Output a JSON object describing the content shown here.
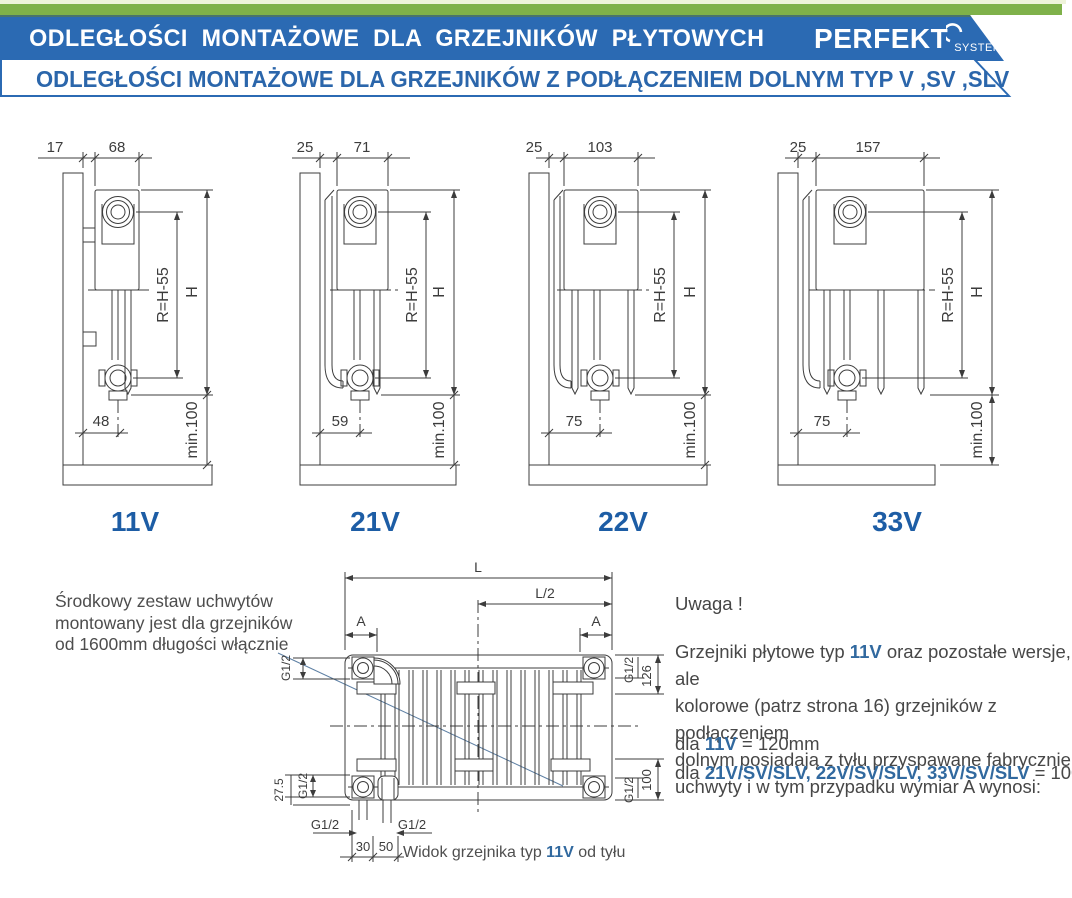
{
  "header": {
    "title": "ODLEGŁOŚCI MONTAŻOWE DLA GRZEJNIKÓW PŁYTOWYCH",
    "brand": "PERFEKT",
    "brand_sub": "SYSTEM",
    "subtitle": "ODLEGŁOŚCI MONTAŻOWE DLA GRZEJNIKÓW Z PODŁĄCZENIEM DOLNYM TYP V ,SV ,SLV",
    "colors": {
      "banner_blue": "#2b6ab3",
      "green": "#7fb14a",
      "accent_blue": "#31699f"
    }
  },
  "diagrams": [
    {
      "type_label": "11V",
      "dim_wall_gap": "17",
      "dim_depth": "68",
      "dim_bottom": "48",
      "dim_height": "H",
      "dim_r": "R=H-55",
      "dim_min": "min.100"
    },
    {
      "type_label": "21V",
      "dim_wall_gap": "25",
      "dim_depth": "71",
      "dim_bottom": "59",
      "dim_height": "H",
      "dim_r": "R=H-55",
      "dim_min": "min.100"
    },
    {
      "type_label": "22V",
      "dim_wall_gap": "25",
      "dim_depth": "103",
      "dim_bottom": "75",
      "dim_height": "H",
      "dim_r": "R=H-55",
      "dim_min": "min.100"
    },
    {
      "type_label": "33V",
      "dim_wall_gap": "25",
      "dim_depth": "157",
      "dim_bottom": "75",
      "dim_height": "H",
      "dim_r": "R=H-55",
      "dim_min": "min.100"
    }
  ],
  "rear_view": {
    "dim_L": "L",
    "dim_L2": "L/2",
    "dim_A_left": "A",
    "dim_A_right": "A",
    "g12_top_left": "G1/2",
    "g12_bottom_left": "G1/2",
    "g12_top_right": "G1/2",
    "g12_bottom_right": "G1/2",
    "g12_pipe1": "G1/2",
    "g12_pipe2": "G1/2",
    "dim_126": "126",
    "dim_100": "100",
    "dim_275": "27.5",
    "dim_30": "30",
    "dim_50": "50",
    "caption_segments": [
      {
        "t": "Widok grzejnika typ ",
        "c": "gray"
      },
      {
        "t": "11V",
        "c": "blue"
      },
      {
        "t": " od tyłu",
        "c": "gray"
      }
    ]
  },
  "left_note": {
    "text": "Środkowy zestaw uchwytów\nmontowany jest dla grzejników\nod 1600mm długości włącznie"
  },
  "right_note": {
    "heading": "Uwaga !",
    "para_segments": [
      {
        "t": "Grzejniki płytowe typ ",
        "c": "gray"
      },
      {
        "t": "11V",
        "c": "blue"
      },
      {
        "t": " oraz pozostałe wersje, ale\nkolorowe (patrz strona 16) grzejników z podłączeniem\ndolnym posiadają z tyłu przyspawane fabrycznie\nuchwyty i w tym przypadku wymiar A wynosi:",
        "c": "gray"
      }
    ],
    "line1_segments": [
      {
        "t": "dla ",
        "c": "gray"
      },
      {
        "t": "11V",
        "c": "blue"
      },
      {
        "t": " = 120mm",
        "c": "gray"
      }
    ],
    "line2_segments": [
      {
        "t": "dla ",
        "c": "gray"
      },
      {
        "t": "21V/SV/SLV, 22V/SV/SLV, 33V/SV/SLV",
        "c": "blue"
      },
      {
        "t": " = 100mm",
        "c": "gray"
      }
    ]
  }
}
